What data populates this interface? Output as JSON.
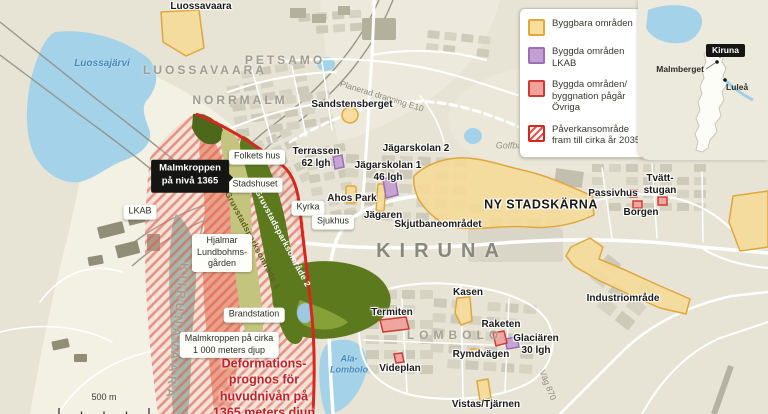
{
  "legend": {
    "items": [
      {
        "label": "Byggbara områden",
        "fill": "#f8dd9b",
        "border": "#e2a83d"
      },
      {
        "label": "Byggda områden\nLKAB",
        "fill": "#c3a0d3",
        "border": "#9b6fb4"
      },
      {
        "label": "Byggda områden/\nbyggnation pågår\nÖvriga",
        "fill": "#f0a29c",
        "border": "#cf3a34"
      },
      {
        "label": "Påverkansområde\nfram till cirka år 2035",
        "fill": "red-diagonal-stripes",
        "border": "#d6261f"
      }
    ]
  },
  "inset": {
    "city": "Kiruna",
    "malmberget": "Malmberget",
    "lulea": "Luleå"
  },
  "districts": {
    "luossavaara": "LUOSSAVAARA",
    "petsamo": "PETSAMO",
    "norrmalm": "NORRMALM",
    "kiruna": "KIRUNA",
    "lombolo": "LOMBOLO",
    "kiirunavaara": "KIIRUNAVAARA"
  },
  "water": {
    "luossajarvi": "Luossajärvi",
    "ala_lombolo": "Ala-\nLombolo"
  },
  "callouts": {
    "malmkroppen_niva": "Malmkroppen\npå nivå 1365",
    "malmkroppen_cirka": "Malmkroppen på cirka\n1 000 meters djup",
    "deformation": "Deformations-\nprognos för\nhuvudnivån på\n1365 meters djup"
  },
  "boxes": {
    "folkets_hus": "Folkets hus",
    "stadshuset": "Stadshuset",
    "kyrka": "Kyrka",
    "sjukhus": "Sjukhus",
    "hjalmar": "Hjalmar\nLundbohms-\ngården",
    "brandstation": "Brandstation",
    "lkab": "LKAB"
  },
  "places": {
    "luossavaara_top": "Luossavaara",
    "sandstensberget": "Sandstensberget",
    "terrassen": "Terrassen\n62 lgh",
    "jagarskolan2": "Jägarskolan 2",
    "jagarskolan1": "Jägarskolan 1\n46 lgh",
    "ahos_park": "Ahos Park",
    "jagaren": "Jägaren",
    "skjutbane": "Skjutbaneområdet",
    "ny_stadskarna": "NY STADSKÄRNA",
    "passivhus": "Passivhus",
    "tvattstugan": "Tvätt-\nstugan",
    "borgen": "Borgen",
    "industriomrade": "Industriområde",
    "kasen": "Kasen",
    "termiten": "Termiten",
    "raketen": "Raketen",
    "glaciaren": "Glaciären\n30 lgh",
    "rymdvagen": "Rymdvägen",
    "videplan": "Videplan",
    "vistas": "Vistas/Tjärnen"
  },
  "roads": {
    "planerad_e10": "Planerad dragning E10",
    "golfbana": "Golfbana",
    "vag870": "Väg 870"
  },
  "parks": {
    "gruvstadspark1": "Gruvstadsparksområde 1",
    "gruvstadspark2": "Gruvstadsparksområde 2"
  },
  "scalebar": {
    "label": "500 m"
  },
  "colors": {
    "impact_line": "#d6261f",
    "orebody": "#e79a7c",
    "park_dark": "#5d791e",
    "park_light": "#c3c47e",
    "water": "#a4d2e8"
  }
}
